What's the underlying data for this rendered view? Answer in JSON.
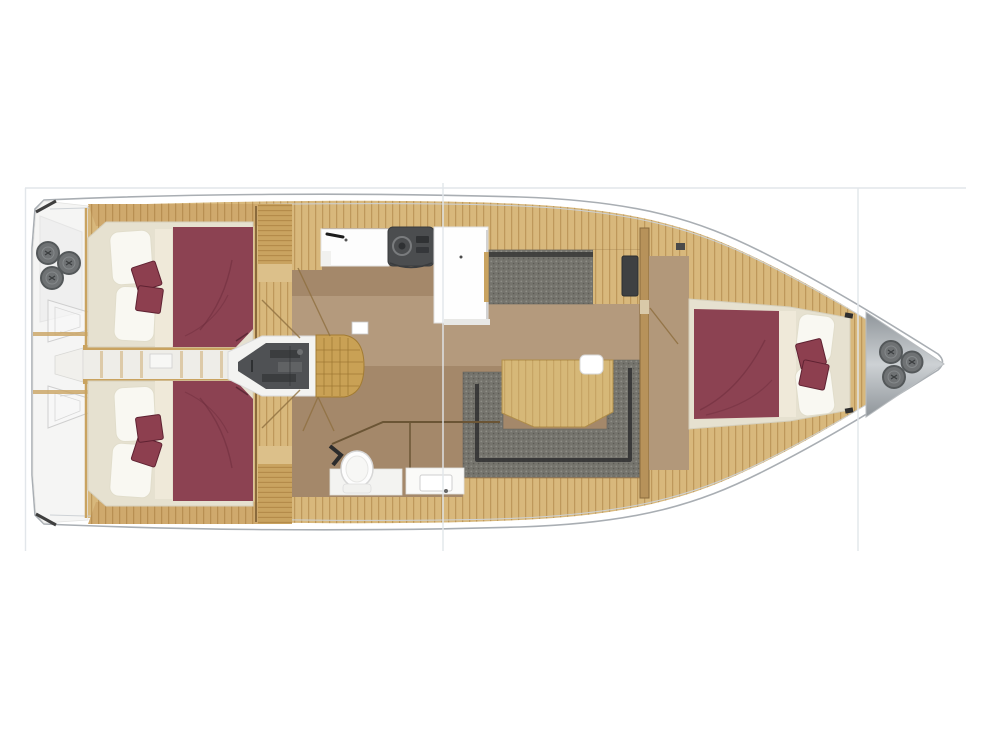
{
  "image": {
    "kind": "yacht-interior-floorplan",
    "orientation": "bow-right",
    "width_px": 990,
    "height_px": 742
  },
  "frame": {
    "seam_line_color": "#e2e6ea"
  },
  "palette": {
    "hull_stroke": "#a9aeb3",
    "hull_inner_line": "#ced2d6",
    "hull_fill": "#ffffff",
    "transom_fill": "#f5f5f4",
    "deck_wood": "#d8b87c",
    "trim_wood": "#c9a360",
    "floor_brown": "#a4886a",
    "floor_fwd": "#b2987a",
    "cream": "#e6e1d0",
    "mattress_strip": "#efe9d9",
    "pillow_white": "#f9f8f2",
    "burgundy": "#8c4252",
    "burgundy_fold": "#6d2d3c",
    "cushion_red": "#8d3f4f",
    "settee_gray": "#75746d",
    "settee_dark": "#2f2f30",
    "engine_gray": "#4f5154",
    "stairs_wood": "#c9a155",
    "counter_white": "#fdfdfd",
    "stove_gray": "#4b4d4f",
    "locker_dark": "#3e4042",
    "anchor_locker_light": "#cdd1d4",
    "anchor_locker_dark": "#8f959a",
    "fitting_gray": "#6f7274",
    "fitting_ring": "#54585a",
    "white_area": "#f3f3f1"
  },
  "diagram": {
    "type": "yacht-interior-floorplan",
    "regions": [
      "transom-swim-platform",
      "aft-cabin-port",
      "aft-cabin-starboard",
      "center-passage",
      "engine-compartment",
      "companionway-steps",
      "galley",
      "refrigerator-unit",
      "salon-settee-forward",
      "salon-table",
      "salon-settee-aft",
      "heads-compartment",
      "forward-cabin",
      "anchor-locker"
    ],
    "counts": {
      "double_berths": 3,
      "red_throw_cushions": 6,
      "round_deck_fittings_stern": 3,
      "round_deck_fittings_bow": 3
    }
  }
}
